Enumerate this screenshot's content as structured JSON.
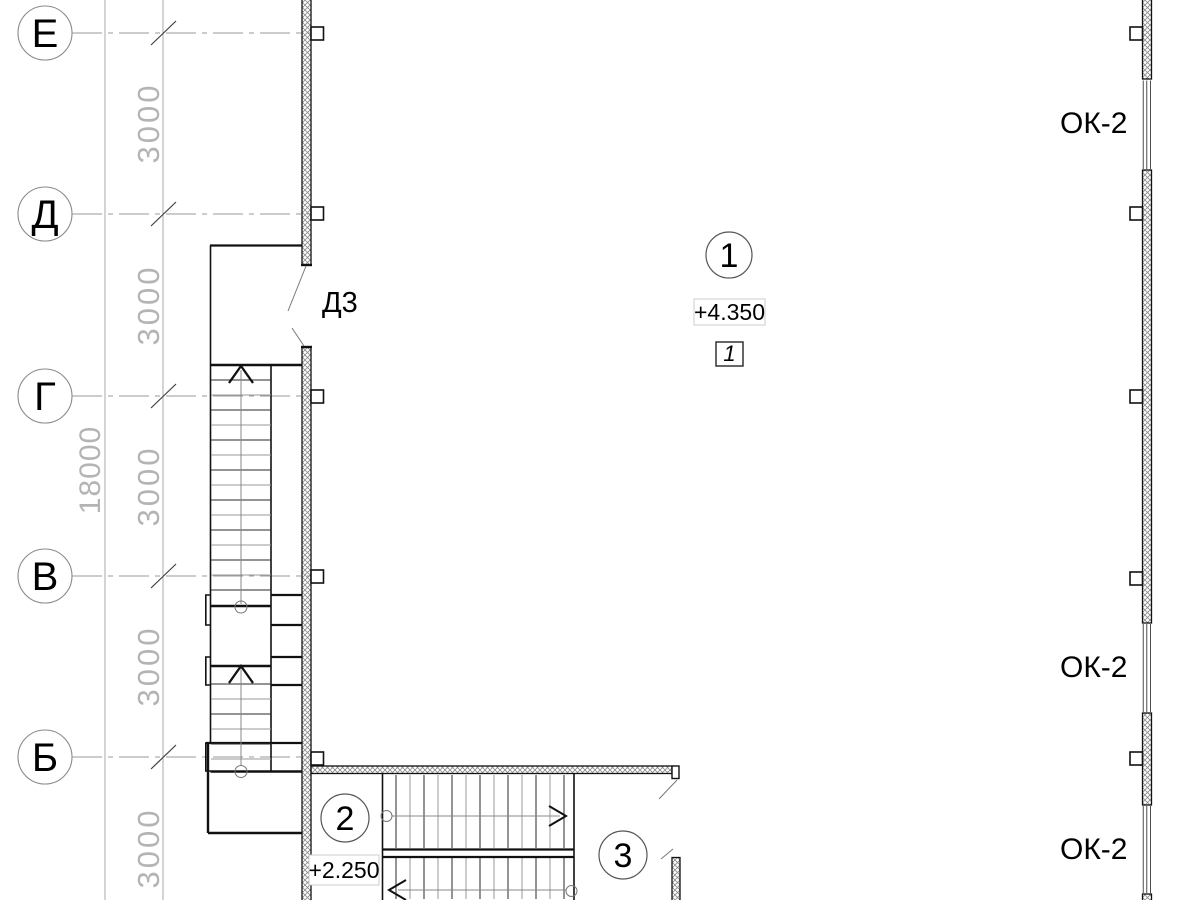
{
  "grid": {
    "axes": [
      {
        "label": "Е"
      },
      {
        "label": "Д"
      },
      {
        "label": "Г"
      },
      {
        "label": "В"
      },
      {
        "label": "Б"
      }
    ],
    "spacing_dims": [
      "3000",
      "3000",
      "3000",
      "3000",
      "3000"
    ],
    "total_dim": "18000"
  },
  "door": {
    "label": "Д3"
  },
  "windows": {
    "labels": [
      "ОК-2",
      "ОК-2",
      "ОК-2"
    ]
  },
  "markers": {
    "node1": {
      "number": "1",
      "elevation": "+4.350",
      "detail_ref": "1"
    },
    "node2": {
      "number": "2",
      "elevation": "+2.250"
    },
    "node3": {
      "number": "3"
    }
  },
  "colors": {
    "line": "#111111",
    "construction": "#9a9a9a",
    "dim_text": "#b4b4b4",
    "hatch": "#8a8a8a"
  }
}
